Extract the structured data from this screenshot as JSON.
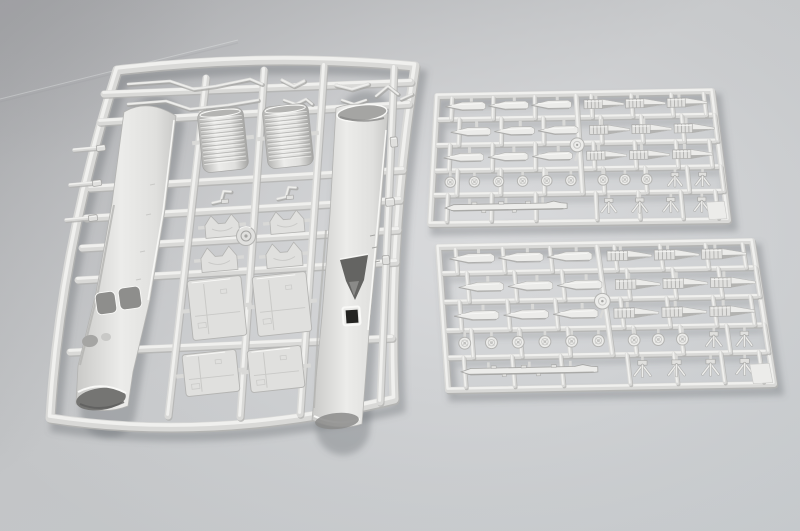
{
  "scene": {
    "type": "photograph",
    "subject": "Plastic scale-model kit sprues",
    "description": "Photograph of three light-gray injection-molded polystyrene model kit sprues lying on a neutral gray studio backdrop: one large frame on the left holding two long fuselage halves, two corrugated engine sections, shaped fittings and panels; two similar smaller frames on the right holding rows of bombs, finned rockets, spoked wheels, tail-fin units and one long rocket each.",
    "background": {
      "corner_shade": "#9fa0a3",
      "mid_tone": "#c3c5c7",
      "highlight": "#dcddDF",
      "bottom_tone": "#c4c8cb"
    },
    "plastic": {
      "rail_light": "#f0f0ee",
      "rail_mid": "#d9d9d7",
      "rail_shade": "#b4b4b2",
      "part_light": "#ececea",
      "part_mid": "#e0e0de",
      "part_dark": "#c9c9c7",
      "line_shade": "#a5a5a3",
      "opening_dark": "#8e8e8c",
      "deep_dark": "#232321",
      "specular": "#f9f9f7",
      "drop_shadow": "rgba(94,97,103,0.33)"
    },
    "sprues": [
      {
        "id": "sprue-large",
        "label": "main airframe sprue",
        "contents": {
          "fuselage_halves": 2,
          "corrugated_sections": 2,
          "shaped_fittings": 4,
          "brackets": 2,
          "large_panels": 2,
          "small_panels": 2,
          "rod_parts": 8,
          "edge_clips": 3,
          "locating_boss": 1
        }
      },
      {
        "id": "sprue-weapons-upper",
        "label": "weapons sprue (upper right)",
        "contents": {
          "smooth_bombs": 9,
          "finned_rockets": 9,
          "spoked_wheels": 9,
          "hub_disc": 1,
          "tail_fin_units": 6,
          "long_rocket": 1,
          "corner_tab": 1
        }
      },
      {
        "id": "sprue-weapons-lower",
        "label": "weapons sprue (lower right)",
        "contents": {
          "smooth_bombs": 9,
          "finned_rockets": 9,
          "spoked_wheels": 9,
          "hub_disc": 1,
          "tail_fin_units": 6,
          "long_rocket": 1,
          "corner_tab": 1
        }
      }
    ]
  }
}
